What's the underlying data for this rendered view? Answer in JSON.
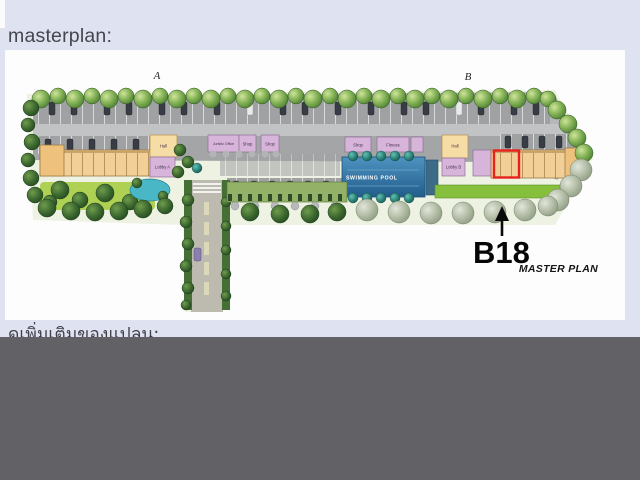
{
  "sections": {
    "masterplan_heading": "masterplan:",
    "next_heading": "ดูเพิ่มเติมของแปลน:"
  },
  "plan": {
    "building_a": "A",
    "building_b": "B",
    "facilities": {
      "juristic_office": "Juristic Office",
      "shop_a1": "Shop",
      "shop_a2": "Shop",
      "hall_a": "Hall",
      "lobby_a": "Lobby A",
      "shop_b": "Shop",
      "fitness": "Fitness",
      "hall_b": "Hall",
      "lobby_b": "Lobby B",
      "swimming_pool": "SWIMMING POOL"
    },
    "highlighted_unit": "B18",
    "caption": "MASTER PLAN",
    "highlight_color": "#e8211c"
  },
  "colors": {
    "page_background": "#dfe2f0",
    "panel_background": "#fdfdfd",
    "bottom_overlay": "#626165",
    "pool_blue": "#2e6d9c",
    "heading_text": "#46464e",
    "annotation_black": "#060606"
  }
}
